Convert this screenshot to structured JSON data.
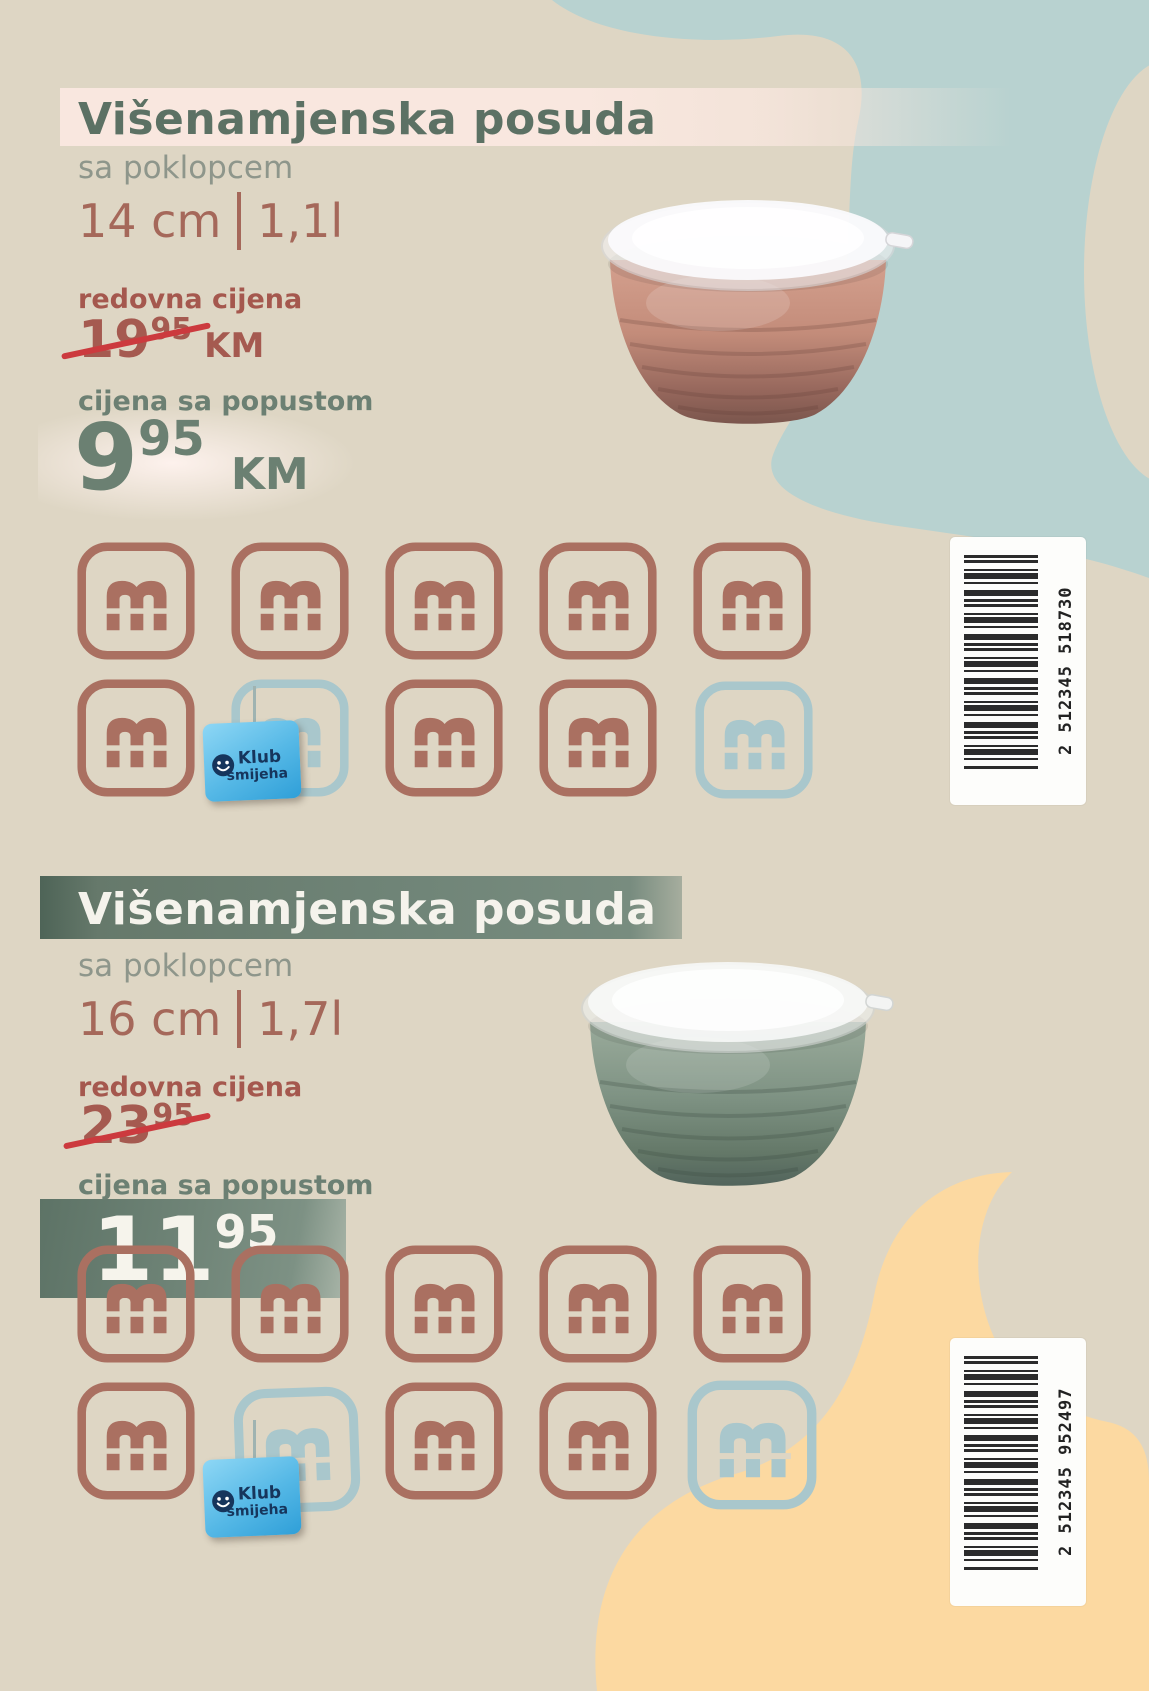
{
  "colors": {
    "background": "#ded6c4",
    "blob_blue": "#b8d2d0",
    "blob_peach": "#fcd9a1",
    "title_green": "#5c7164",
    "band_pink": "#f9e7df",
    "text_gray": "#8e968b",
    "accent_rust": "#a5685a",
    "regular_price_red": "#a5584e",
    "strike_red": "#cc3a3e",
    "discount_green": "#6b8072",
    "stamp_brown": "#aa7061",
    "stamp_blue": "#a9c7cc",
    "badge_blue": "#2f9fd8",
    "badge_text": "#16355c",
    "barcode_ink": "#2b2b2b"
  },
  "product1": {
    "title": "Višenamjenska posuda",
    "subtitle": "sa poklopcem",
    "dimension": "14 cm",
    "volume": "1,1l",
    "regular_price_label": "redovna cijena",
    "regular_price": "19",
    "regular_price_sup": "95",
    "regular_price_currency": "KM",
    "discount_price_label": "cijena sa popustom",
    "discount_price": "9",
    "discount_price_sup": "95",
    "discount_price_currency": "KM",
    "barcode_number": "2 512345 518730",
    "stamps": [
      "brown",
      "brown",
      "brown",
      "brown",
      "brown",
      "brown",
      "blue",
      "brown",
      "brown",
      "blue"
    ],
    "badge": {
      "line1": "Klub",
      "line2": "smijeha"
    }
  },
  "product2": {
    "title": "Višenamjenska posuda",
    "subtitle": "sa poklopcem",
    "dimension": "16 cm",
    "volume": "1,7l",
    "regular_price_label": "redovna cijena",
    "regular_price": "23",
    "regular_price_sup": "95",
    "discount_price_label": "cijena sa popustom",
    "discount_price": "11",
    "discount_price_sup": "95",
    "barcode_number": "2 512345 952497",
    "stamps": [
      "brown",
      "brown",
      "brown",
      "brown",
      "brown",
      "brown",
      "blue",
      "brown",
      "brown",
      "blue"
    ],
    "badge": {
      "line1": "Klub",
      "line2": "smijeha"
    }
  }
}
